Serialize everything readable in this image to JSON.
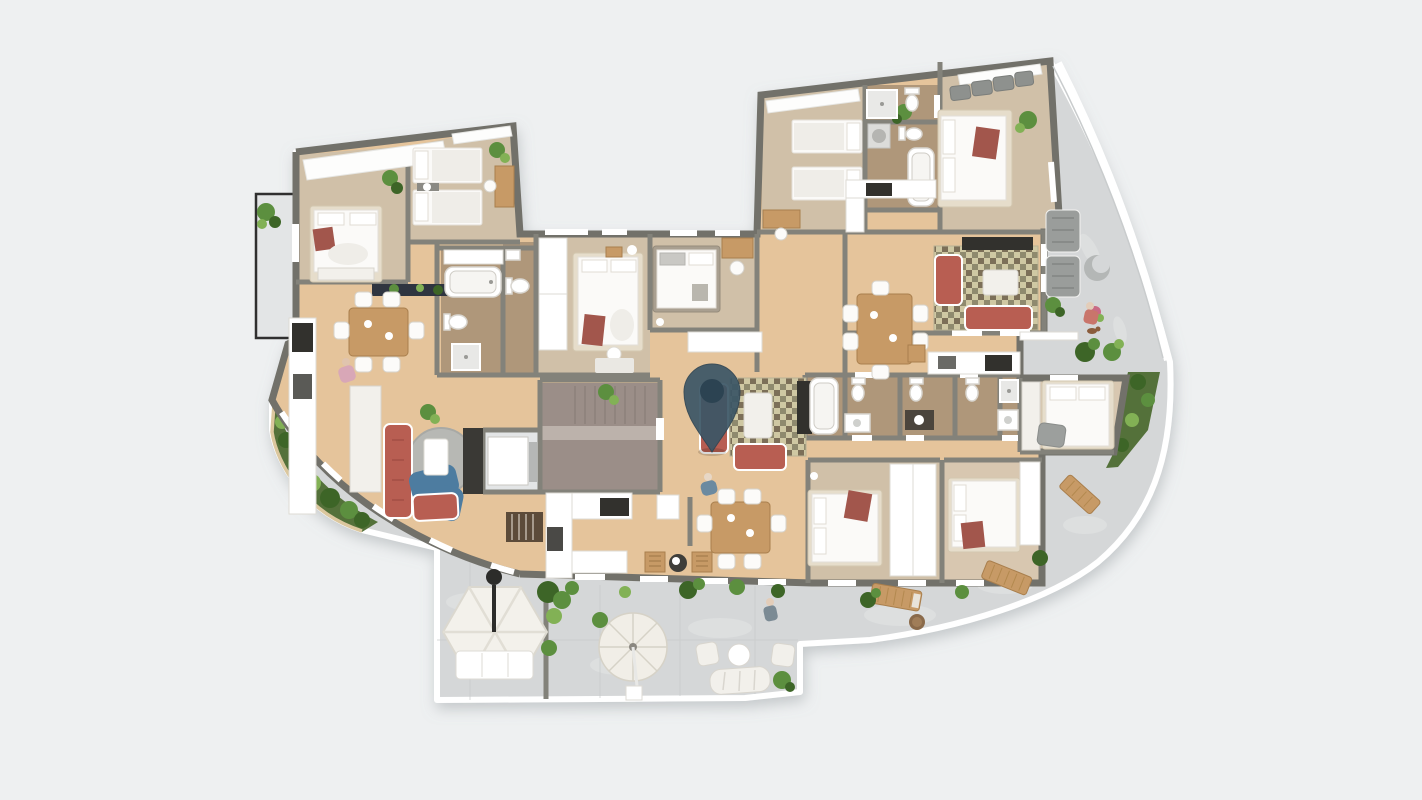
{
  "colors": {
    "canvas": "#eef0f1",
    "stone": "#d5d7d8",
    "stonelight": "#e3e5e6",
    "wood": "#e5c49b",
    "grayfloor": "#b7bab9",
    "grayfloorlight": "#c8cbca",
    "bathfloor": "#6e6152",
    "corefloor": "#9b8e88",
    "corelight": "#bcb2ab",
    "wall": "#83827a",
    "walldark": "#72716a",
    "offwhite": "#f2f0eb",
    "sofared": "#b85e52",
    "armchairblue": "#4d7ca0",
    "ruggray": "#b7b8b4",
    "rugolive": "#cfc8a3",
    "rugolivedark": "#8f8a6e",
    "rugbrown": "#7c6f58",
    "woodfurn": "#c79a66",
    "woodfurndark": "#a97f4d",
    "dark": "#32312d",
    "graysofa": "#9a9d9b",
    "green": "#5c8f3f",
    "greendark": "#3d6527",
    "greenlight": "#82b155",
    "garden": "#54713a",
    "pin": "#3b5666",
    "pindark": "#2c4352",
    "throwred": "#a2564c",
    "stairbrown": "#5c4b39",
    "pink": "#d8a7b7",
    "glassline": "#c9cccd"
  },
  "elements": [
    "map-pin-marker",
    "stair-core",
    "elevator",
    "balcony",
    "garden-bed",
    "bedroom-double",
    "bedroom-twin",
    "bed",
    "wardrobe",
    "bathtub",
    "toilet",
    "shower",
    "washbasin",
    "kitchen-counter",
    "cooktop",
    "kitchen-island",
    "dining-table",
    "dining-chair",
    "sofa",
    "loveseat",
    "chaise-lounge",
    "armchair",
    "coffee-table",
    "tv-sideboard",
    "round-rug",
    "checkered-rug",
    "gazebo",
    "patio-umbrella",
    "sun-lounger",
    "outdoor-sofa",
    "bistro-set",
    "potted-plant",
    "terrace",
    "person-figure",
    "dog-figure"
  ]
}
